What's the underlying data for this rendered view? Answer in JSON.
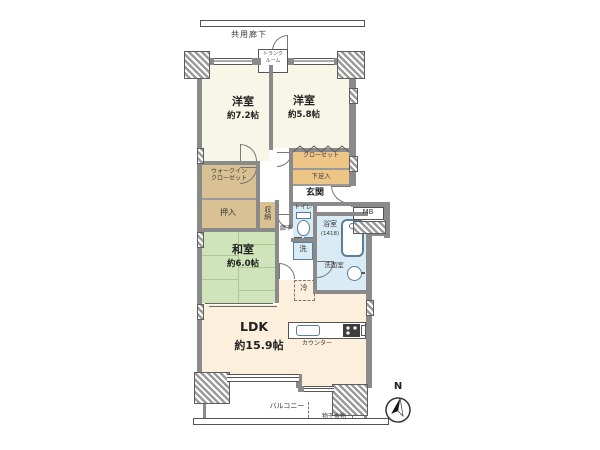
{
  "colors": {
    "wall": "#8a8a8a",
    "west": "#f8f6e6",
    "tatami": "#cfe4ba",
    "tatami_line": "#a9c88f",
    "ldk": "#fcefdc",
    "closet_a": "#edc687",
    "closet_b": "#d9c193",
    "wet": "#d9ebf4",
    "fixture": "#5a7d99"
  },
  "plan": {
    "common_corridor": "共用廊下",
    "trunk_line1": "トランク",
    "trunk_line2": "ルーム",
    "bedroom1_name": "洋室",
    "bedroom1_size": "約7.2帖",
    "bedroom2_name": "洋室",
    "bedroom2_size": "約5.8帖",
    "closet": "クローゼット",
    "shoe_box": "下足入",
    "entrance": "玄関",
    "wic_line1": "ウォークイン",
    "wic_line2": "クローゼット",
    "oshiire": "押入",
    "storage": "収納",
    "hallway": "廊下",
    "toilet": "トイレ",
    "meter_box": "MB",
    "bath": "浴室",
    "bath_size": "(1418)",
    "washroom": "洗面室",
    "washer": "洗",
    "fridge": "冷",
    "japanese_name": "和室",
    "japanese_size": "約6.0帖",
    "ldk_name": "LDK",
    "ldk_size": "約15.9帖",
    "counter": "カウンター",
    "balcony": "バルコニー",
    "laundry_fitting": "物干金物",
    "north": "N"
  }
}
